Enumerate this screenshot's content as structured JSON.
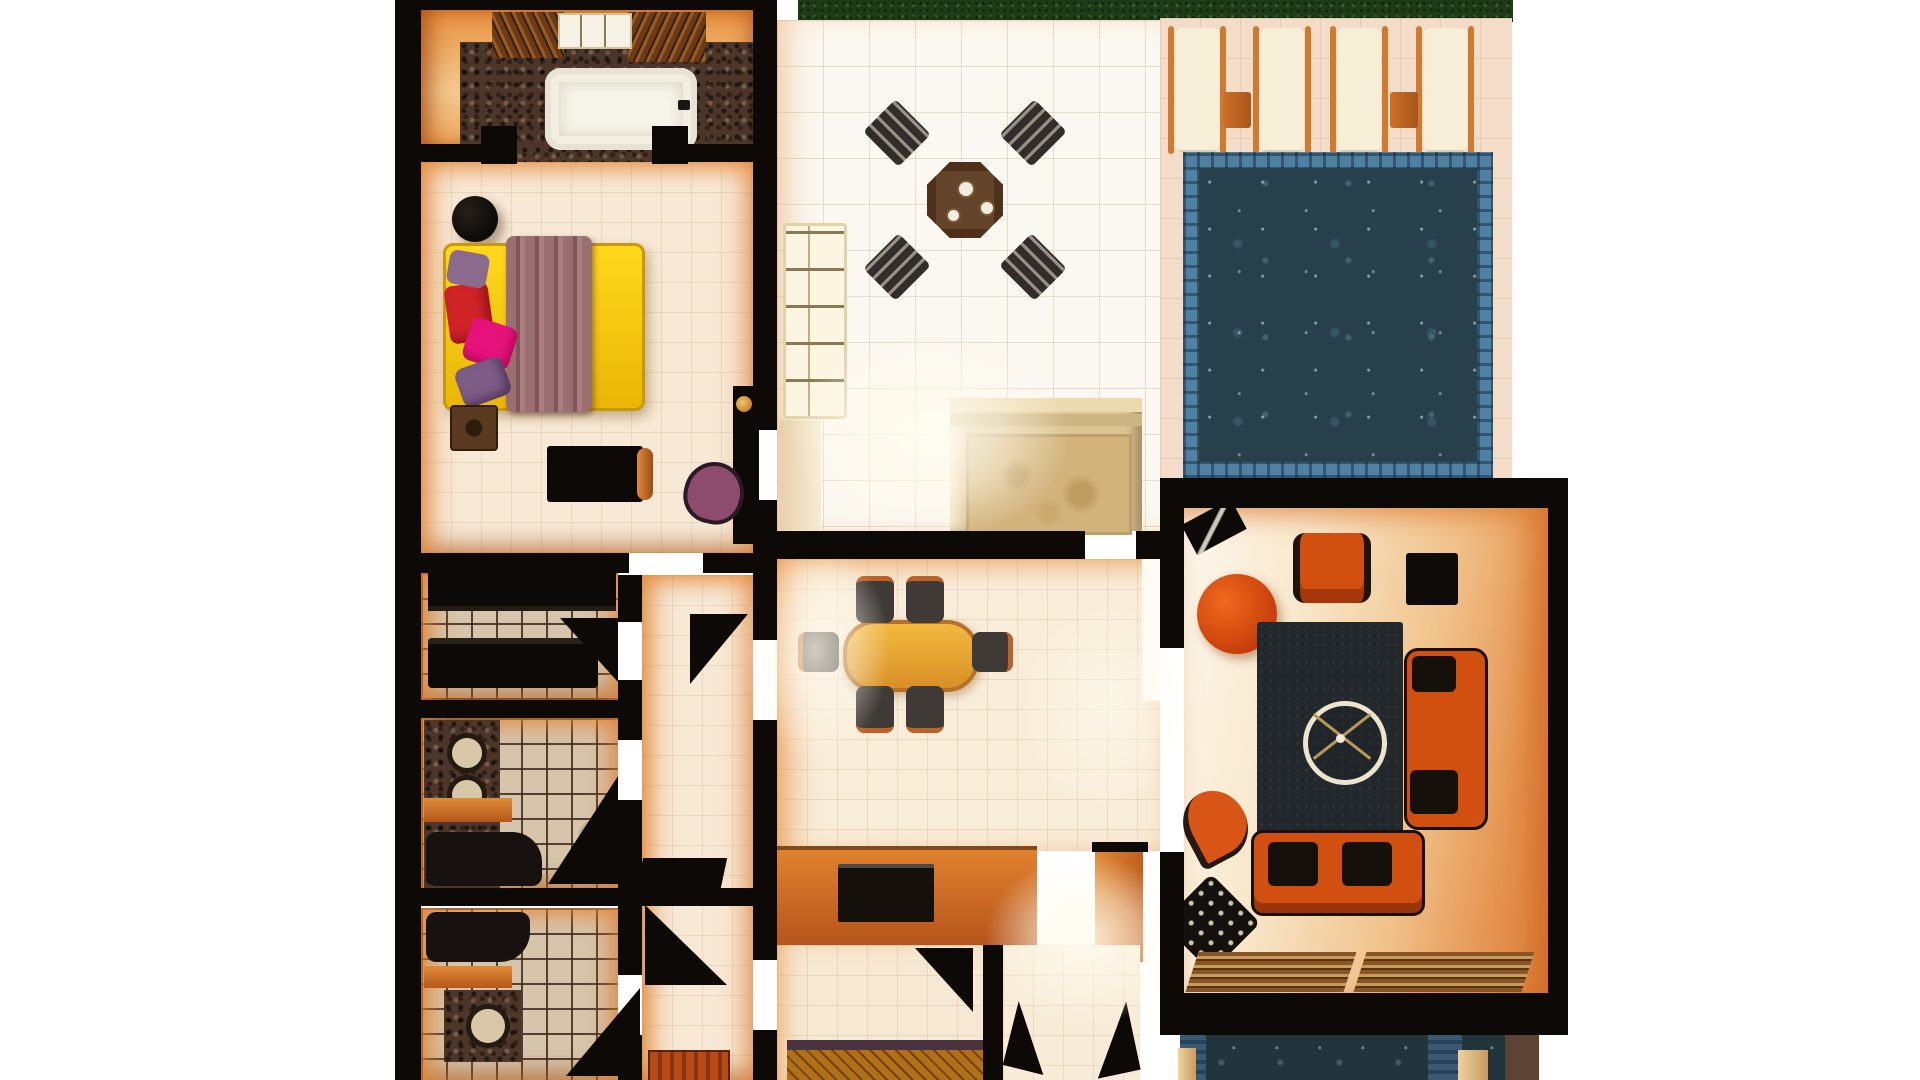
{
  "scene": {
    "title": "3D rendered residential floor plan, top-down view",
    "style": "photorealistic evening render with warm orange wall lighting",
    "background": "white"
  },
  "palette": {
    "bg": "#ffffff",
    "wall": "#0c0907",
    "glow": "#e78a3c",
    "grass": "#1f3c18",
    "deck": "#f3ddc9",
    "pool-tile": "#4f81a2",
    "pool-water": "#27404b",
    "patio": "#fbf8f1",
    "tile": "#f7e9d6",
    "grout": "#d7c5ab",
    "orange": "#d2500f",
    "sofa-black": "#16100b",
    "rug": "#23282c",
    "bed-yellow": "#f2c50a",
    "blanket": "#9a6f71",
    "table-yellow": "#e8a93c",
    "mosaic": "#4c3629",
    "spa": "#dcc493",
    "mat": "#d4a94e"
  },
  "rooms": [
    {
      "id": "master-bathroom",
      "label": "Master bathroom with bathtub"
    },
    {
      "id": "master-bedroom",
      "label": "Master bedroom"
    },
    {
      "id": "walk-in-closet",
      "label": "Walk-in closet"
    },
    {
      "id": "bathroom-1",
      "label": "Bathroom with twin sinks"
    },
    {
      "id": "bathroom-2",
      "label": "Bathroom"
    },
    {
      "id": "hallway",
      "label": "Hallway"
    },
    {
      "id": "patio-terrace",
      "label": "Patio terrace"
    },
    {
      "id": "spa-steps",
      "label": "Spa / steps beside pool"
    },
    {
      "id": "dining-room",
      "label": "Dining room"
    },
    {
      "id": "living-room",
      "label": "Living room"
    },
    {
      "id": "foyer",
      "label": "Entry foyer"
    },
    {
      "id": "pool",
      "label": "Swimming pool"
    },
    {
      "id": "pool-deck",
      "label": "Pool deck with sun loungers"
    },
    {
      "id": "garden-strip",
      "label": "Garden grass strip"
    },
    {
      "id": "water-feature",
      "label": "Lower water feature"
    }
  ],
  "furniture": {
    "bed": "double bed with yellow mattress, mauve throw and pillows",
    "bed_pillow_count": 4,
    "bathtub": "white bathtub on dark stone mosaic",
    "sun_lounger_count": 4,
    "lounger_side_table_count": 2,
    "patio_set": {
      "table": "octagonal wood table",
      "chair_count": 4
    },
    "dining_set": {
      "table": "oval yellow-wood table",
      "chair_count": 6
    },
    "living_room": [
      "orange armchair",
      "round orange ottoman",
      "black side table",
      "dark area rug",
      "ceiling fan",
      "orange sofa vertical",
      "orange sofa horizontal",
      "curved orange chair",
      "dotted black ottoman",
      "wood slat blinds"
    ],
    "other": [
      "black dresser",
      "wardrobe",
      "purple accent chair",
      "round pouf",
      "vanity sinks",
      "tv console on orange media wall",
      "woven entry mat",
      "interior door swings"
    ]
  }
}
